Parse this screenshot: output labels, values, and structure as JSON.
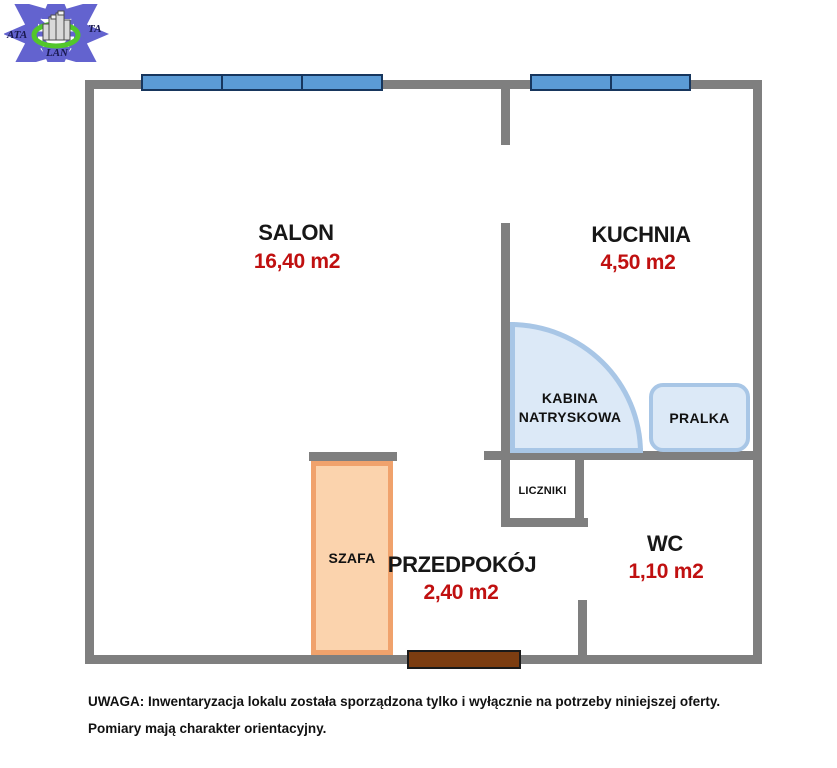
{
  "logo": {
    "text_left": "ATA",
    "text_right": "TA",
    "text_bottom": "LAN"
  },
  "rooms": {
    "salon": {
      "name": "SALON",
      "area": "16,40 m2"
    },
    "kuchnia": {
      "name": "KUCHNIA",
      "area": "4,50 m2"
    },
    "przedpokoj": {
      "name": "PRZEDPOKÓJ",
      "area": "2,40 m2"
    },
    "wc": {
      "name": "WC",
      "area": "1,10 m2"
    }
  },
  "fixtures": {
    "shower_line1": "KABINA",
    "shower_line2": "NATRYSKOWA",
    "washer": "PRALKA",
    "meters": "LICZNIKI",
    "wardrobe": "SZAFA"
  },
  "note": {
    "line1": "UWAGA: Inwentaryzacja lokalu została sporządzona tylko i wyłącznie na potrzeby niniejszej oferty.",
    "line2": "Pomiary mają charakter orientacyjny."
  },
  "colors": {
    "wall": "#7f7f7f",
    "window_fill": "#5b9bd5",
    "window_border": "#17365d",
    "area_text": "#c01010",
    "fixture_fill": "#dce9f7",
    "fixture_border": "#a8c6e6",
    "wardrobe_fill": "#fbd3ad",
    "wardrobe_border": "#f0a26c",
    "door_fill": "#7c3d11",
    "logo_arrows": "#6363cf",
    "logo_ring": "#52c62b"
  }
}
